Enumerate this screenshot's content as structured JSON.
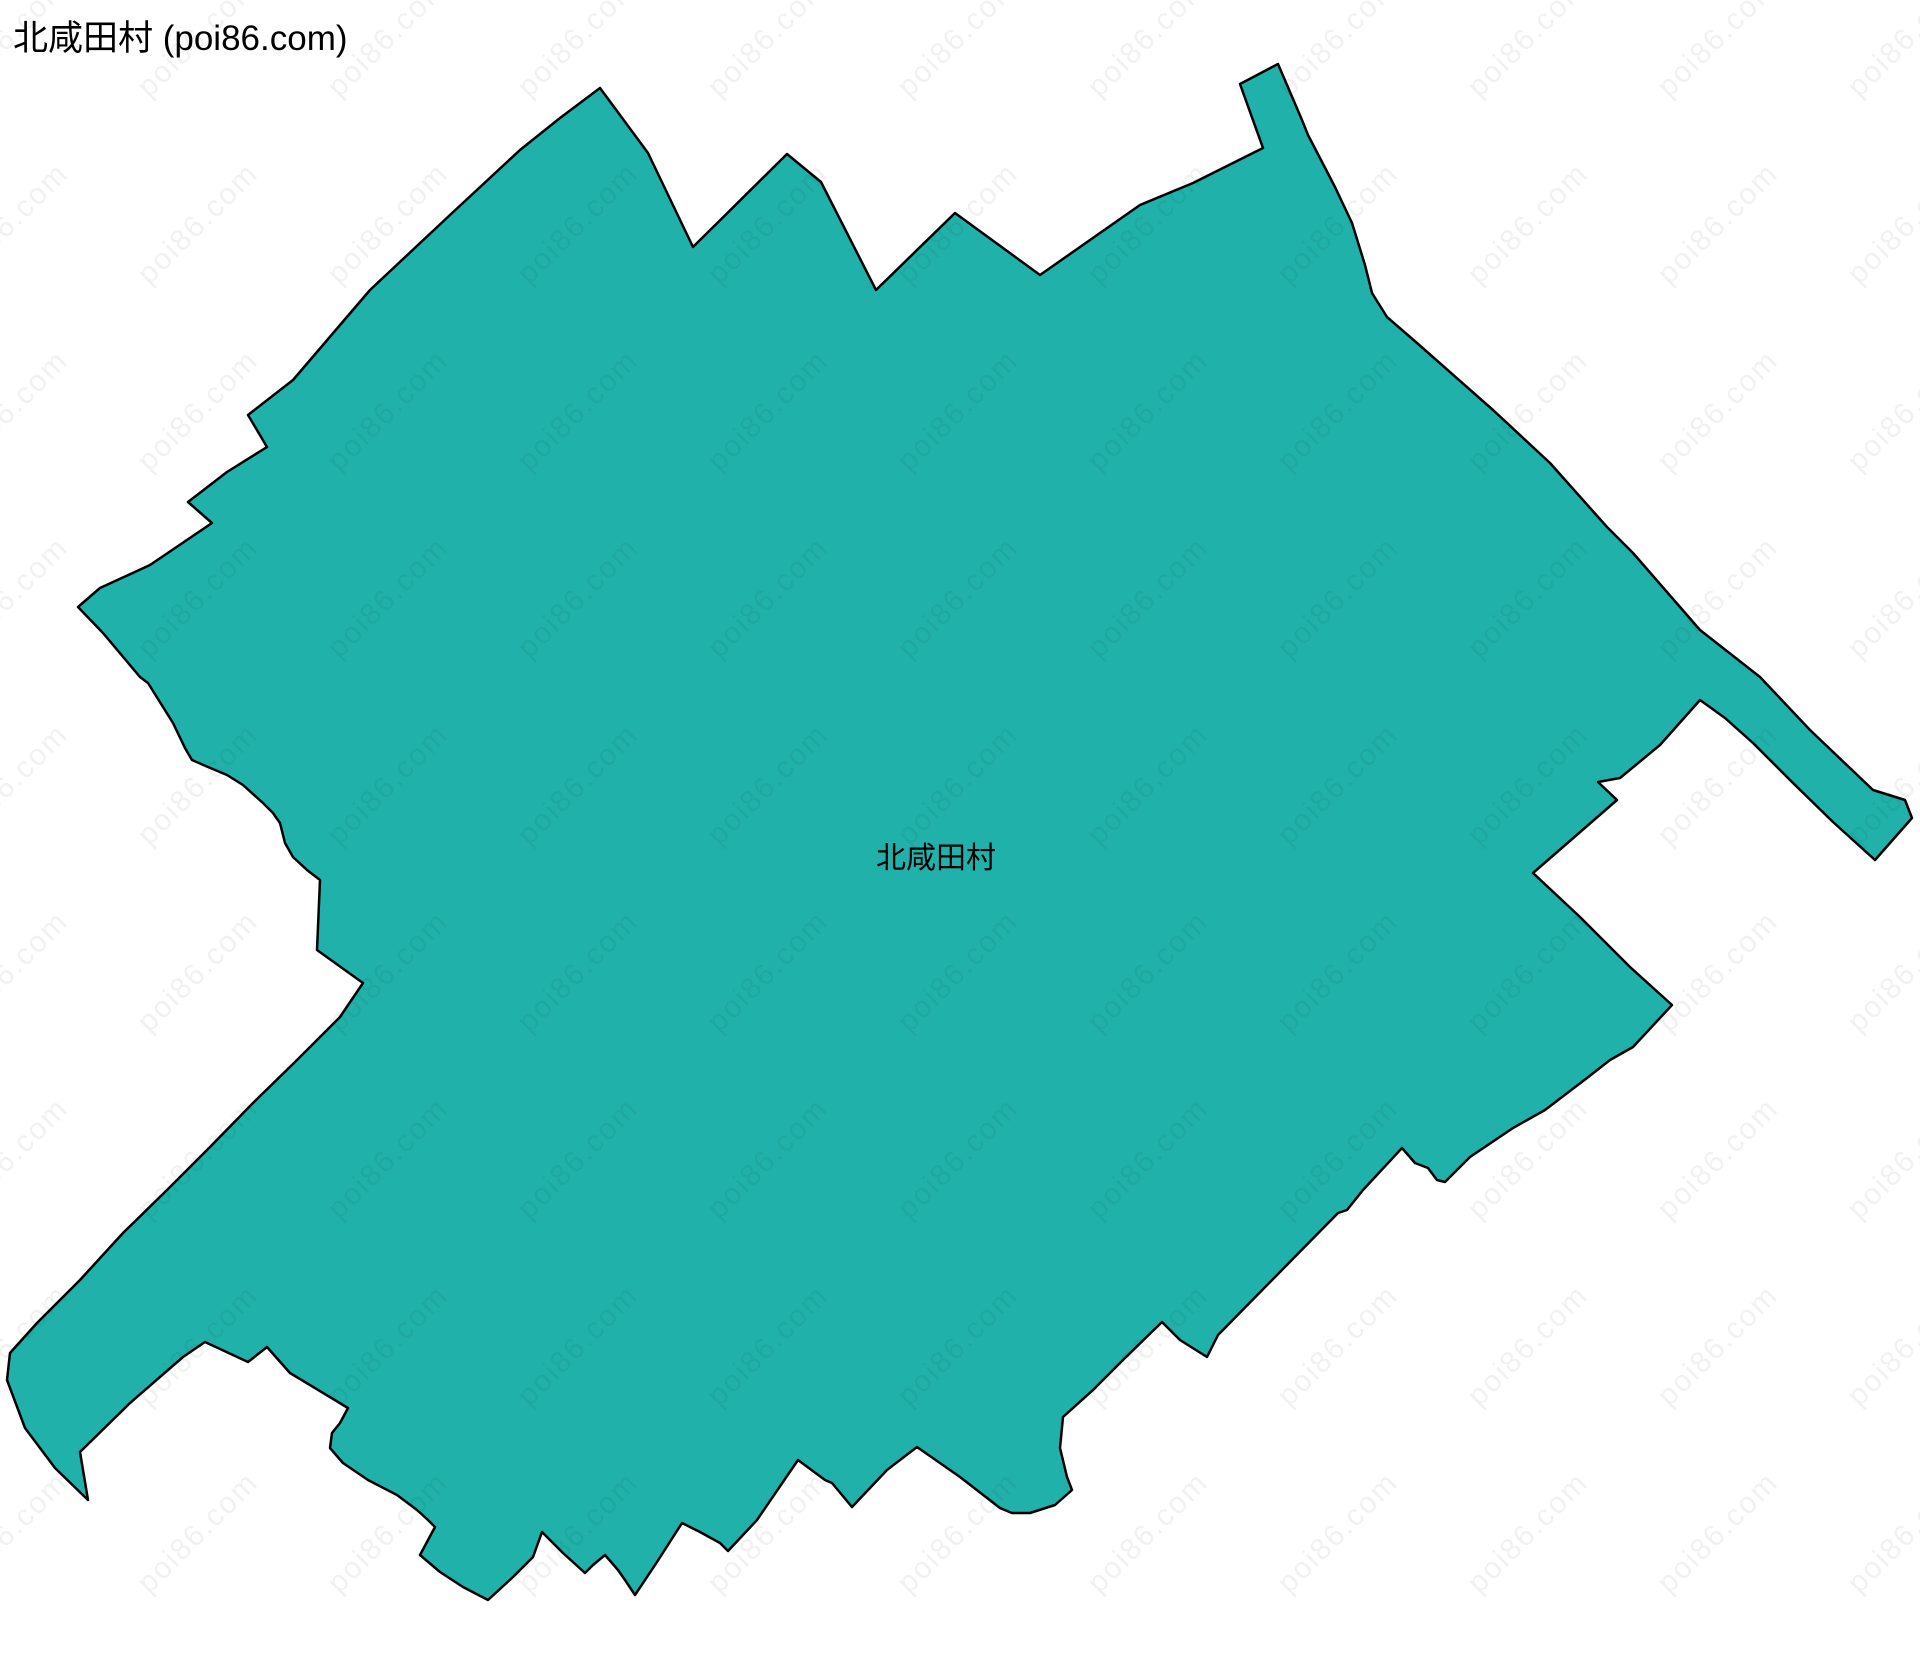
{
  "page": {
    "title": "北咸田村 (poi86.com)",
    "background_color": "#ffffff"
  },
  "watermark": {
    "text": "poi86.com"
  },
  "map": {
    "region_name": "北咸田村",
    "region_label": "北咸田村",
    "fill_color": "#20b2aa",
    "border_color": "#000000",
    "polygon_points": "600,88 648,153 693,247 787,154 821,182 876,290 955,213 1040,275 1140,205 1193,183 1263,148 1240,84 1278,64 1302,120 1308,135 1335,187 1352,223 1365,265 1372,293 1387,317 1417,343 1493,410 1550,463 1607,527 1633,553 1700,630 1760,677 1810,730 1873,790 1905,800 1912,818 1875,860 1833,822 1793,783 1753,743 1725,718 1700,700 1660,745 1620,778 1598,782 1617,800 1533,873 1580,917 1630,967 1672,1005 1633,1047 1610,1060 1587,1078 1545,1110 1513,1128 1470,1157 1445,1182 1437,1180 1428,1168 1415,1163 1402,1148 1363,1190 1347,1210 1338,1213 1218,1335 1207,1357 1180,1340 1162,1322 1123,1360 1093,1390 1063,1417 1060,1448 1067,1477 1072,1490 1055,1505 1030,1513 1012,1513 1000,1508 960,1477 917,1447 887,1470 852,1507 832,1483 825,1480 798,1460 757,1520 728,1551 720,1543 700,1532 682,1523 657,1562 635,1595 625,1580 618,1570 605,1555 593,1565 585,1573 563,1553 542,1532 533,1557 513,1577 488,1600 463,1587 440,1572 420,1555 435,1527 428,1520 417,1510 397,1495 368,1480 343,1463 330,1448 332,1433 340,1423 348,1408 290,1373 267,1347 248,1362 205,1342 183,1357 130,1403 80,1452 88,1500 55,1468 25,1428 7,1380 10,1353 37,1323 80,1280 123,1233 167,1190 210,1147 253,1103 297,1060 340,1017 363,983 317,950 320,880 307,870 293,857 285,843 280,823 273,813 263,803 243,785 227,775 208,767 192,760 185,748 173,723 148,683 140,677 103,633 78,607 100,588 150,565 212,523 188,502 227,472 267,447 248,415 293,380 370,290 450,215 520,150 560,118"
  }
}
